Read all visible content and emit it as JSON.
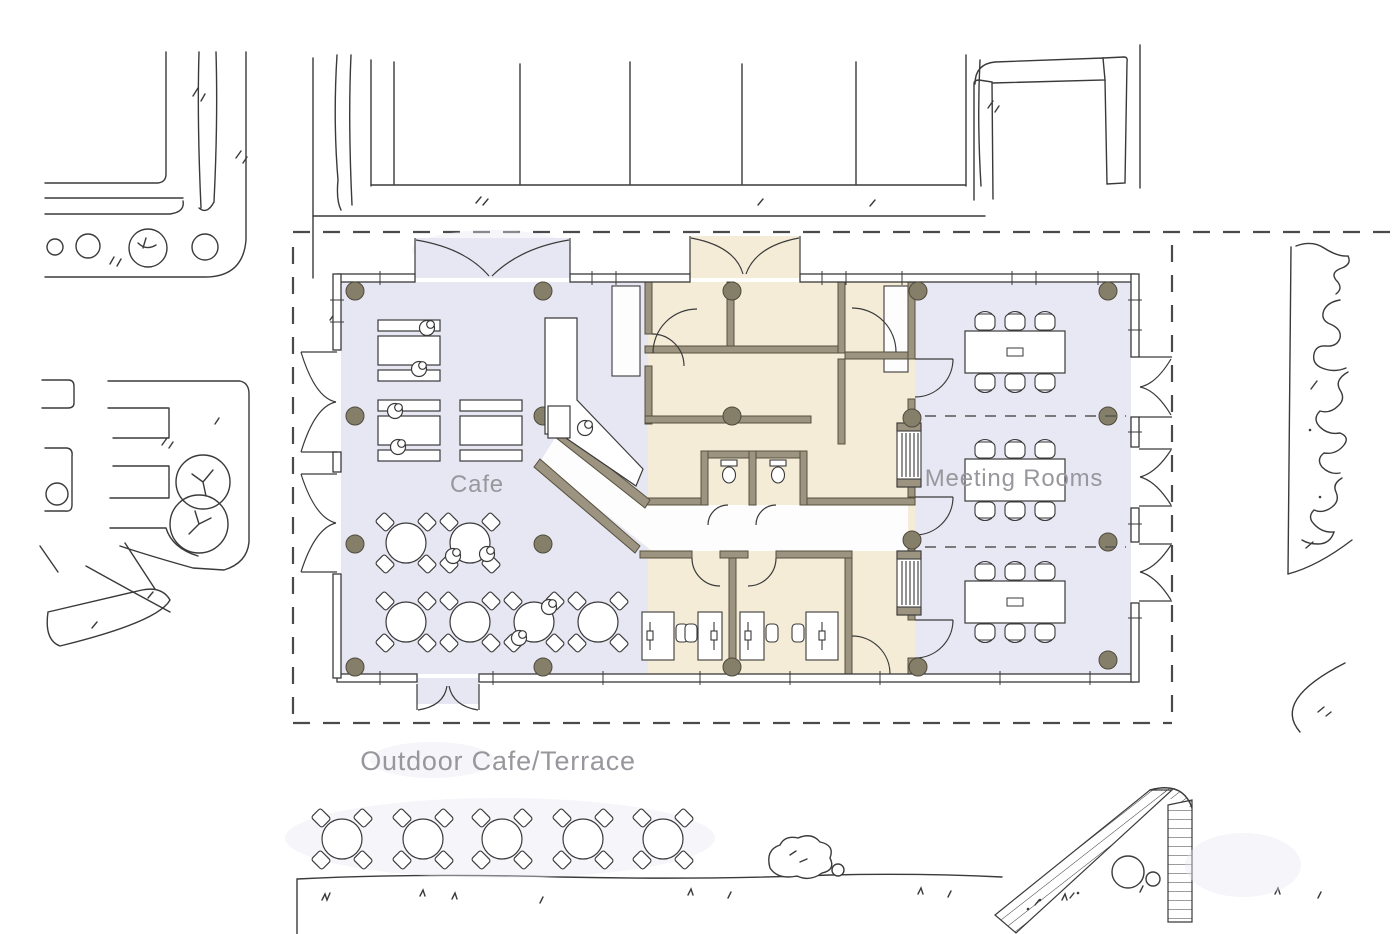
{
  "labels": {
    "cafe": "Cafe",
    "meeting_rooms": "Meeting Rooms",
    "outdoor_terrace": "Outdoor Cafe/Terrace"
  },
  "colors": {
    "paper": "#ffffff",
    "cafe_zone": "#e7e7f3",
    "office_core_zone": "#f5ecd8",
    "meeting_zone": "#e8e8f4",
    "wall_poche": "#9c9480",
    "wall_outline": "#55503e",
    "column": "#857f6a",
    "sketch_line": "#3a3a3a",
    "label_text": "#97979d",
    "boundary_dash": "#4a4a4a"
  },
  "plan": {
    "zones": [
      {
        "name": "Cafe",
        "fill_key": "cafe_zone"
      },
      {
        "name": "Office core",
        "fill_key": "office_core_zone"
      },
      {
        "name": "Meeting Rooms",
        "fill_key": "meeting_zone"
      }
    ],
    "cafe": {
      "communal_tables": 3,
      "round_tables": 6,
      "seated_people": 9,
      "counter": 1
    },
    "meeting_rooms": {
      "rooms": 3,
      "tables": 3,
      "chairs_per_table": 6
    },
    "offices": {
      "desks": 4,
      "wc_cubicles": 2
    },
    "terrace": {
      "round_tables": 5,
      "chairs_per_table": 4
    },
    "structure": {
      "column_grid_rows": 4,
      "column_grid_cols": 5,
      "entrances": 3
    }
  }
}
